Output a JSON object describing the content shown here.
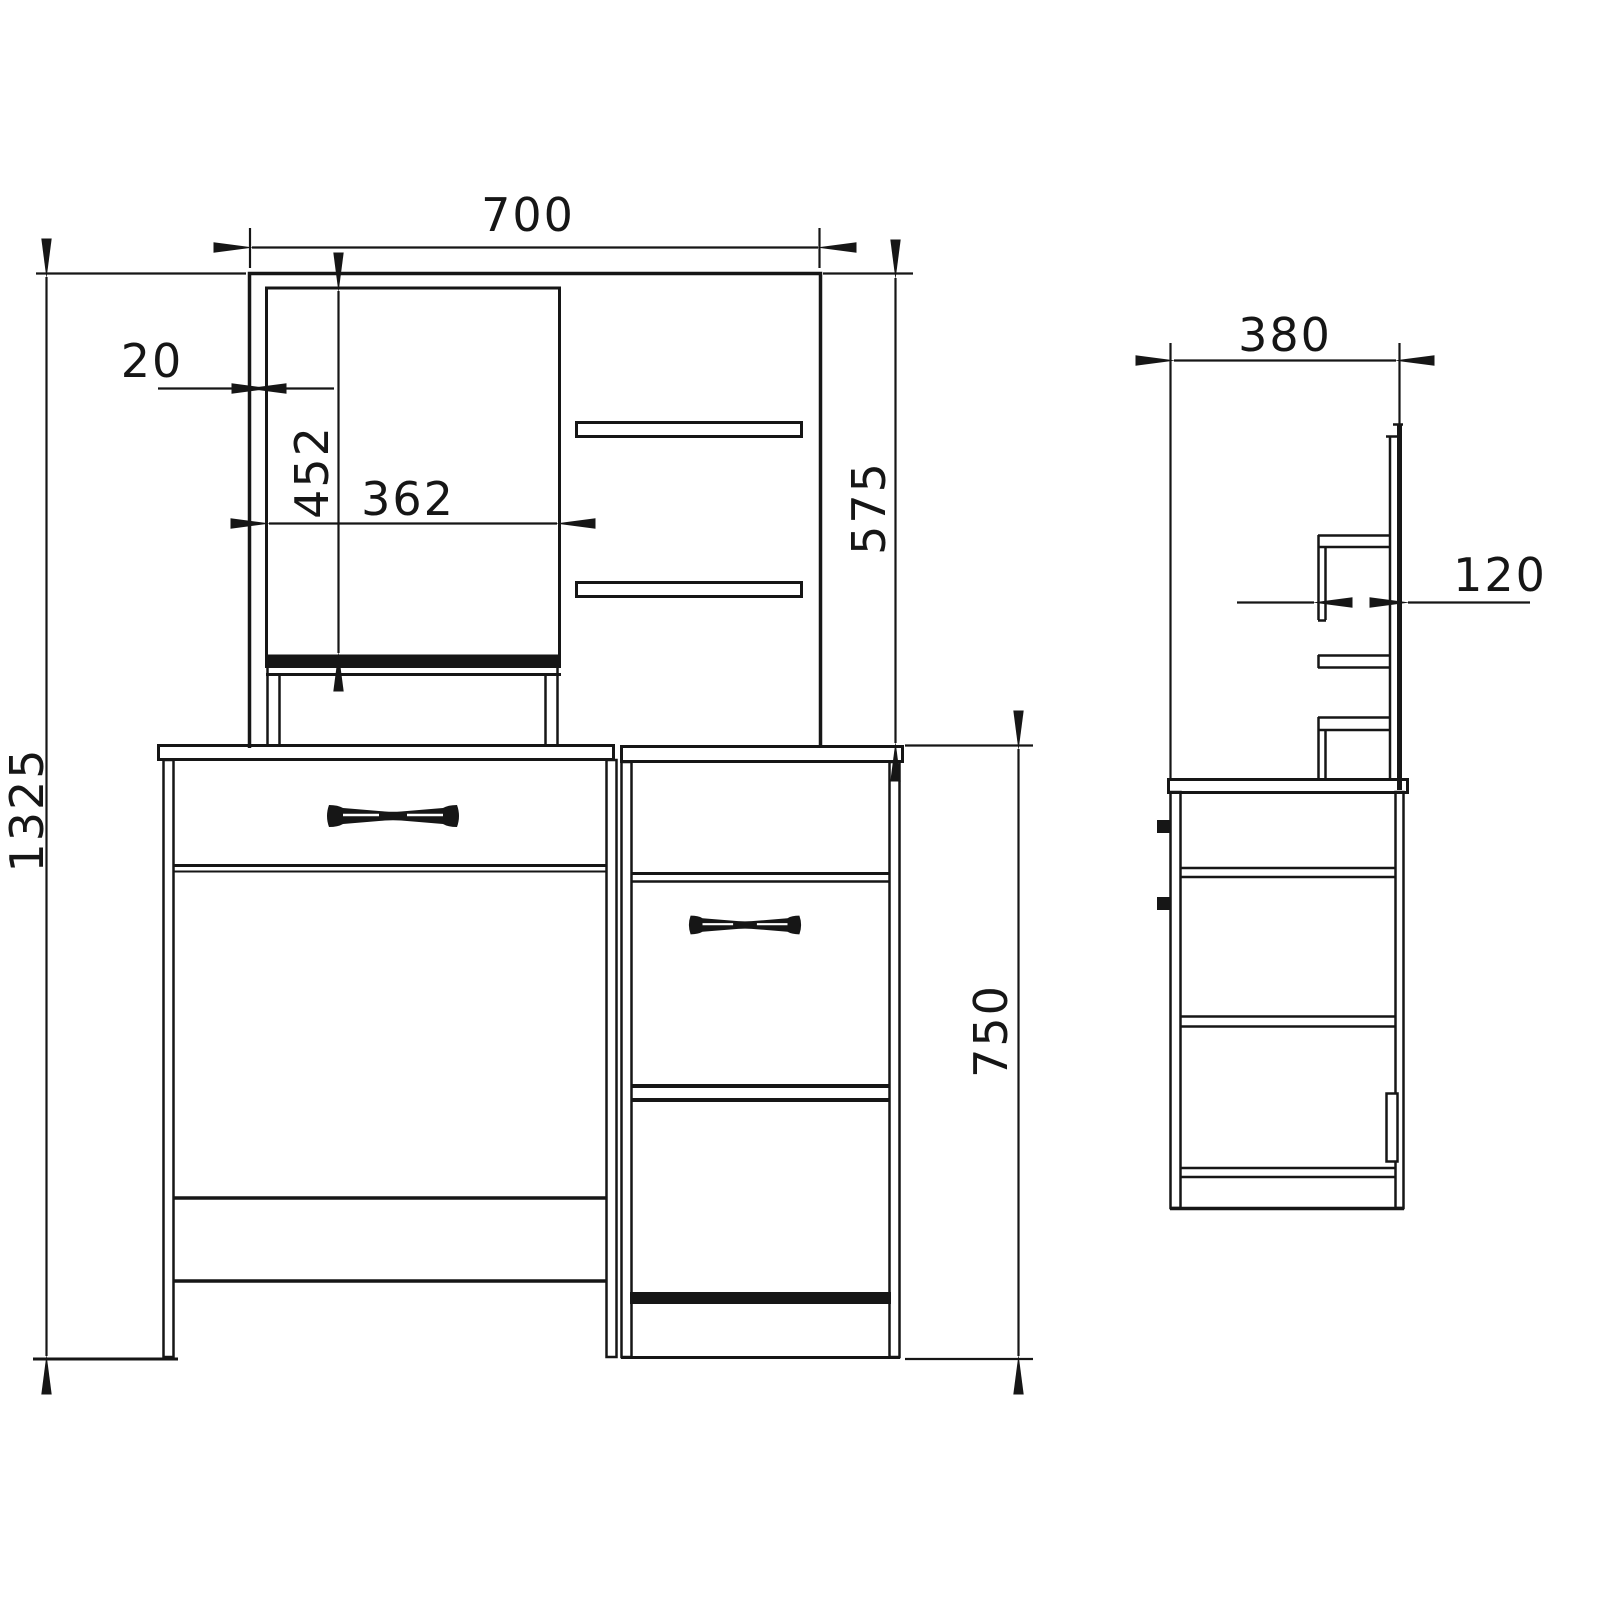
{
  "drawing": {
    "kind": "furniture technical drawing",
    "subject": "dressing table with mirror, shelves and drawer pedestal - front and side elevation",
    "background_color": "#ffffff",
    "line_color": "#161616",
    "front_view": {
      "overall_width_mm": "700",
      "mirror_offset_mm": "20",
      "mirror_height_mm": "452",
      "mirror_width_mm": "362",
      "upper_section_height_mm": "575",
      "overall_height_mm": "1325",
      "table_height_mm": "750"
    },
    "side_view": {
      "depth_mm": "380",
      "shelf_depth_mm": "120"
    }
  }
}
